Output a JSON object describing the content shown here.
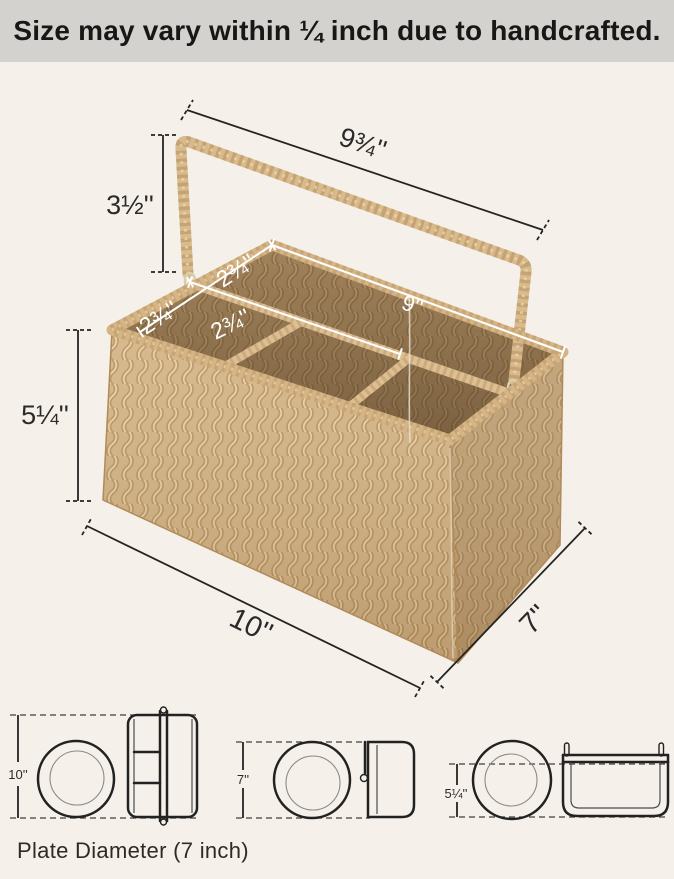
{
  "header": {
    "notice": "Size may vary within ¼ inch due to handcrafted."
  },
  "product": {
    "description": "woven seagrass utensil caddy basket with folding handle and four compartments"
  },
  "dimensions": {
    "handle_width": "9¾''",
    "handle_height": "3½''",
    "basket_height": "5¼''",
    "compartment_depth_front": "2¾''",
    "compartment_depth_back": "2¾''",
    "compartment_width": "2¾''",
    "long_compartment": "9''",
    "basket_length": "10''",
    "basket_depth": "7''"
  },
  "size_comparison": {
    "top_view": "10''",
    "side_view": "7''",
    "front_view": "5¼''",
    "caption": "Plate Diameter (7 inch)"
  },
  "colors": {
    "header_bg": "#d3d2cf",
    "page_bg": "#f5f1ea",
    "basket_tan": "#d2b284",
    "basket_shadow": "#b9925f",
    "basket_highlight": "#e6d0a4",
    "dimension_line": "#242424",
    "annotation_white": "#ffffff",
    "sketch_line": "#222222"
  }
}
